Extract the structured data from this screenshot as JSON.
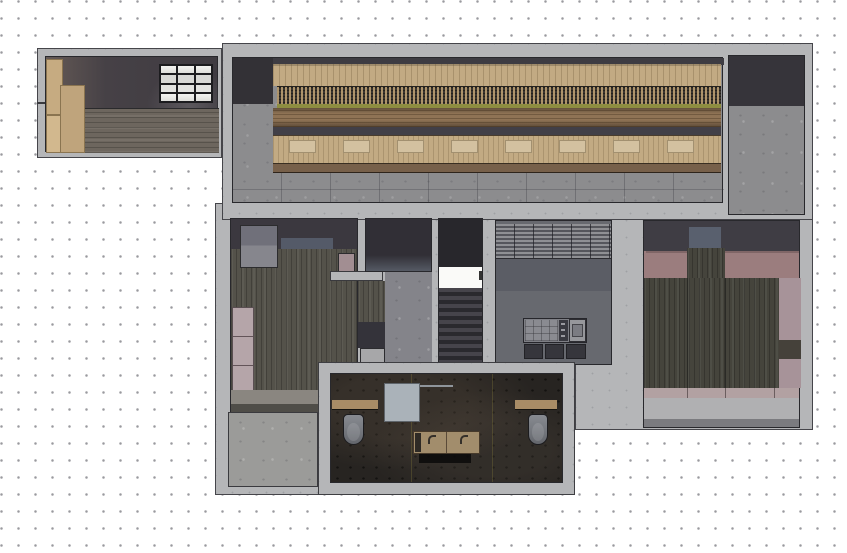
{
  "canvas": {
    "kind": "architectural-floor-plan-render",
    "grid": {
      "spacing_px": 17,
      "dot_color": "#9a9a9e",
      "background": "#ffffff"
    }
  },
  "palette": {
    "bg": "#ffffff",
    "grid_dot": "#9a9a9e",
    "wall": "#b5b6b8",
    "wall_dot": "#9fa0a3",
    "outline": "#45454a",
    "room_border": "#28282c",
    "concrete": "#8c8c8e",
    "patio_concrete": "#9b9b99",
    "dark_band": "#3e3c42",
    "darker_block": "#333136",
    "wood_tan": "#c2aa83",
    "wood_tan_light": "#d3c1a0",
    "screen_dark": "#3a352f",
    "olive": "#8d8d40",
    "counter_brown": "#8f7355",
    "bench_edge": "#77604a",
    "annex_wall_dark": "#464146",
    "annex_floor": "#6d665e",
    "cabinet_tan": "#c6ab81",
    "window_frame": "#1c1c1f",
    "window_pane": "#f3f3f1",
    "bedroom_wood": "#54524a",
    "closet_gray": "#83838a",
    "rug_blue": "#596070",
    "wardrobe_mauve": "#b5a5a9",
    "corridor_gray": "#84848a",
    "dark_room": "#312f36",
    "stair_dark": "#28272c",
    "stair_landing": "#fafaf8",
    "kitchen_floor": "#67696f",
    "kitchen_mid": "#5b5d65",
    "island_dark": "#36363c",
    "island_counter": "#7e7f85",
    "rb_pink": "#9b7d7e",
    "rb_pink_light": "#b2a1a2",
    "rb_mauve": "#a79399",
    "rb_wood": "#45443c",
    "rb_blue": "#59606e",
    "bath_floor": "#272421",
    "bath_wood": "#a88c66",
    "vanity_tan": "#a28d6c",
    "panel_gray": "#aab2b9"
  },
  "plan": {
    "rooms": [
      {
        "name": "entry-room",
        "fixtures": [
          "cabinet-stack",
          "window",
          "wood-floor"
        ]
      },
      {
        "name": "main-hall",
        "fixtures": [
          "slatted-screen",
          "bar-counter",
          "bench-seating",
          "concrete-floor"
        ]
      },
      {
        "name": "storage-room",
        "fixtures": [
          "concrete-floor"
        ]
      },
      {
        "name": "bedroom-west",
        "fixtures": [
          "closet",
          "rug",
          "wardrobe",
          "side-table",
          "wood-floor"
        ]
      },
      {
        "name": "inner-room",
        "fixtures": []
      },
      {
        "name": "hallway",
        "fixtures": []
      },
      {
        "name": "staircase",
        "fixtures": [
          "landing",
          "steps"
        ]
      },
      {
        "name": "kitchen",
        "fixtures": [
          "slat-blind-band",
          "kitchen-island",
          "oven",
          "drawers"
        ]
      },
      {
        "name": "bedroom-east",
        "fixtures": [
          "bed-platform",
          "rug",
          "pink-carpet"
        ]
      },
      {
        "name": "bathroom",
        "fixtures": [
          "toilet",
          "toilet",
          "double-sink-vanity",
          "glass-panel",
          "wood-shelf",
          "wood-shelf"
        ]
      },
      {
        "name": "patio",
        "fixtures": [
          "concrete-slab"
        ]
      }
    ]
  }
}
